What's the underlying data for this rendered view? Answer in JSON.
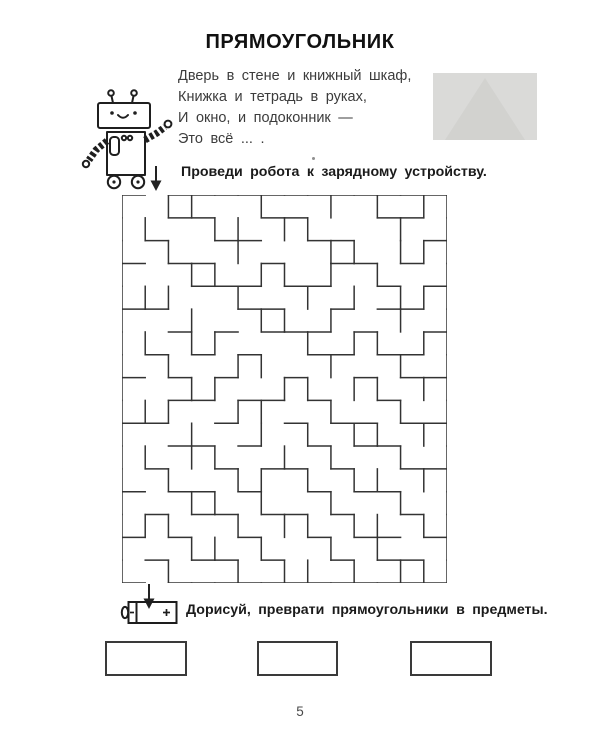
{
  "header": {
    "title": "ПРЯМОУГОЛЬНИК"
  },
  "poem": {
    "lines": [
      "Дверь в стене и книжный шкаф,",
      "Книжка и тетрадь в руках,",
      "И окно, и подоконник —",
      "Это всё ... ."
    ]
  },
  "tasks": {
    "maze_instruction": "Проведи робота к зарядному устройству.",
    "draw_instruction": "Дорисуй, преврати прямоугольники в предметы."
  },
  "icons": {
    "robot": "robot-line-drawing",
    "battery": "battery-charger",
    "entry_arrow": "down-arrow",
    "exit_arrow": "down-arrow"
  },
  "battery": {
    "plus_label": "+",
    "minus_label": "−"
  },
  "practice_boxes": {
    "count": 3
  },
  "footer": {
    "page_number": "5"
  },
  "colors": {
    "ink": "#1f1f1f",
    "text": "#3c3c3c",
    "maze_wall": "#333333",
    "faded_photo_bg": "#dadad8"
  },
  "maze": {
    "cols": 14,
    "rows": 17,
    "width": 325,
    "height": 388,
    "wall_color": "#333333",
    "entry": "top col 1",
    "exit": "bottom col 1",
    "h": [
      "10111111111111",
      "00110011000110",
      "01001100110001",
      "10110010011010",
      "00011101100101",
      "11000110010110",
      "00101011101001",
      "01010100110110",
      "10101001001011",
      "00110110100100",
      "11001001011011",
      "00110100101100",
      "01001011010011",
      "10110100101100",
      "01011011010010",
      "10100100101101",
      "01011010010110",
      "10111111111111"
    ],
    "v": [
      "101100100101011",
      "110011011000101",
      "101001000110111",
      "100110110101001",
      "111001001010111",
      "100100110100101",
      "110110001011011",
      "101001100100101",
      "100110011011011",
      "111001100100101",
      "100100101011011",
      "110110010100101",
      "101001101011011",
      "100110100100101",
      "111001011011011",
      "100110100101001",
      "101001011010111"
    ]
  }
}
